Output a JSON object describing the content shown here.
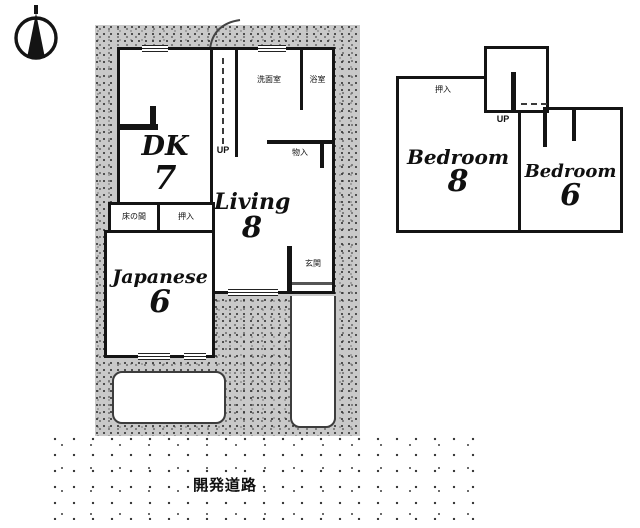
{
  "compass": {
    "icon": "north-arrow"
  },
  "floor1": {
    "dk": {
      "name": "DK",
      "tatami": "7"
    },
    "living": {
      "name": "Living",
      "tatami": "8"
    },
    "japanese": {
      "name": "Japanese",
      "tatami": "6"
    },
    "washroom_label": "洗面室",
    "bath_label": "浴室",
    "storage_label": "物入",
    "tokonoma_label": "床の間",
    "closet_label": "押入",
    "entrance_label": "玄関",
    "stairs_label": "UP"
  },
  "floor2": {
    "bedroom_left": {
      "name": "Bedroom",
      "tatami": "8"
    },
    "bedroom_right": {
      "name": "Bedroom",
      "tatami": "6"
    },
    "closet_label": "押入",
    "stairs_label": "UP"
  },
  "road_label": "開発道路",
  "colors": {
    "wall": "#141414",
    "lot_bg": "#c9c9c9"
  }
}
